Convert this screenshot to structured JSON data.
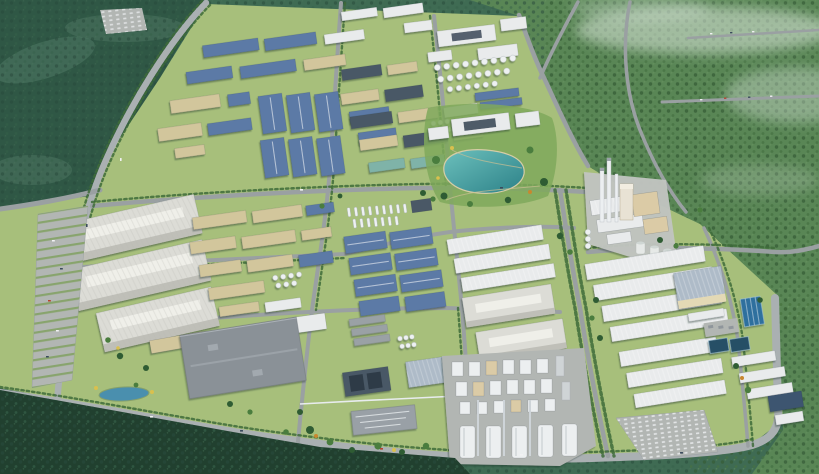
{
  "image": {
    "kind": "3d-aerial-render",
    "subject": "Aerial bird's-eye rendering of an industrial park with factory clusters, warehouses, a central lake, a cement plant and a chemical plant, surrounded by forested hills",
    "width_px": 819,
    "height_px": 474
  },
  "regions": [
    "forest-hills",
    "industrial-park-grounds",
    "factory-cluster-northwest",
    "factory-cluster-north-central",
    "white-plant-and-tank-farm",
    "lakefront-campus",
    "central-lake",
    "mega-warehouses-west",
    "parking-lot-west",
    "factory-cluster-central",
    "grey-distribution-center",
    "blue-warehouse-grid",
    "white-warehouse-rows-central",
    "chemical-plant",
    "silo-row",
    "cement-plant",
    "warehouse-rows-east",
    "water-treatment-pools",
    "parking-lot-south",
    "pond",
    "road-network",
    "mist-haze"
  ],
  "colors": {
    "forestBase": "#3f6b53",
    "forestDeep": "#2c5242",
    "forestFg": "#21402f",
    "forestTeal": "#57806b",
    "forestLight": "#5c8a55",
    "mist": "#e9f1ea",
    "parkGround": "#a7bf7b",
    "gardenGreen": "#7fa85c",
    "roadMain": "#9aa0a2",
    "roadWide": "#aab0b2",
    "treeLine": "#3e6b3a",
    "treeDot": "#2f5c33",
    "treeDot2": "#4a7d3e",
    "accentYellow": "#d9c04e",
    "accentOrange": "#c8872f",
    "roofBlue": "#5b7aa6",
    "roofBlueDark": "#3c556f",
    "roofSlate": "#4a5866",
    "roofWhite": "#e9ebec",
    "roofSilver": "#aebbc8",
    "roofGreyDeep": "#8a9197",
    "roofTeal": "#7fb3a8",
    "hallLight": "#dcdcd6",
    "hallRidge": "#efefe9",
    "hallSide": "#bfbfb8",
    "cream": "#d2c69c",
    "creamWall": "#e3d9b5",
    "tankWhite": "#eef1f2",
    "lakeShallow": "#6cc0bc",
    "lakeDeep": "#2c8188",
    "lakeShore": "#d6cda6",
    "pond": "#4a8fae",
    "pool": "#2f6f9e",
    "poolDark": "#274f66",
    "padConcrete": "#b2b6b3",
    "padLight": "#c2c5c1",
    "plantWhite": "#eceff0",
    "plantTan": "#dbcba6",
    "chimney": "#eceff1",
    "carWhite": "#f2f2f4",
    "carDark": "#3a4a5c",
    "carRed": "#b5432f",
    "shadow": "#1f2f26"
  }
}
